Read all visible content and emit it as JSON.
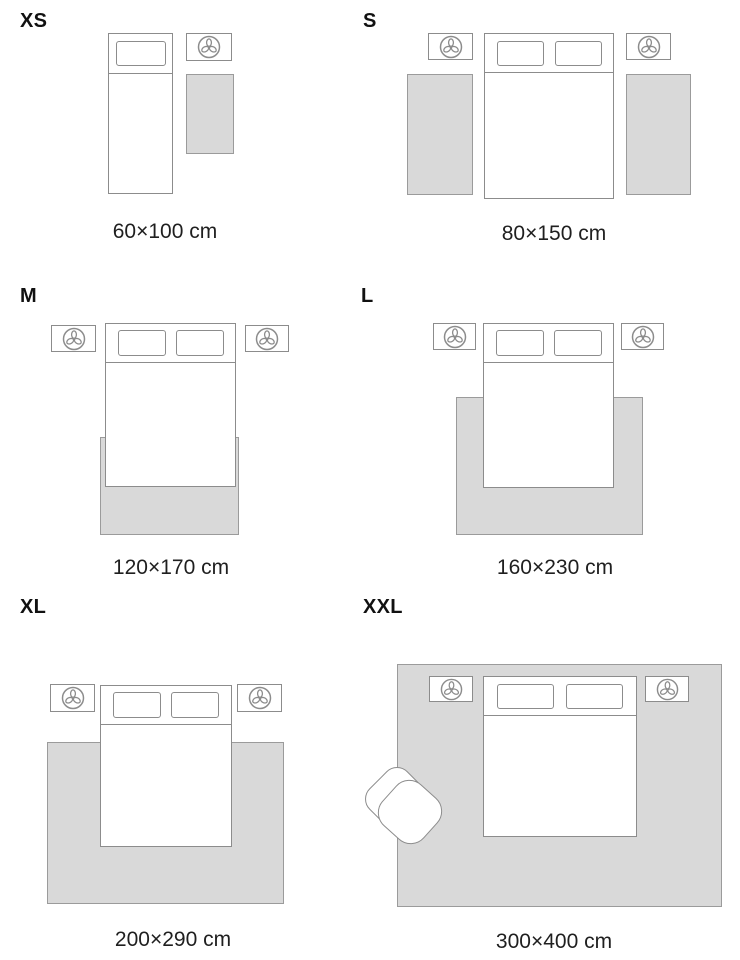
{
  "guide": {
    "panels": [
      {
        "id": "xs",
        "label": "XS",
        "caption": "60×100 cm"
      },
      {
        "id": "s",
        "label": "S",
        "caption": "80×150 cm"
      },
      {
        "id": "m",
        "label": "M",
        "caption": "120×170 cm"
      },
      {
        "id": "l",
        "label": "L",
        "caption": "160×230 cm"
      },
      {
        "id": "xl",
        "label": "XL",
        "caption": "200×290 cm"
      },
      {
        "id": "xxl",
        "label": "XXL",
        "caption": "300×400 cm"
      }
    ]
  },
  "icons": {
    "nightstand_icon": "plant-top-view",
    "furniture_shapes": [
      "bed",
      "pillow",
      "nightstand",
      "rug",
      "armchair"
    ]
  },
  "colors": {
    "background": "#ffffff",
    "outline": "#8c8c8c",
    "rug_fill": "#d9d9d9",
    "rug_border": "#9b9b9b",
    "text": "#1f1f1f"
  }
}
